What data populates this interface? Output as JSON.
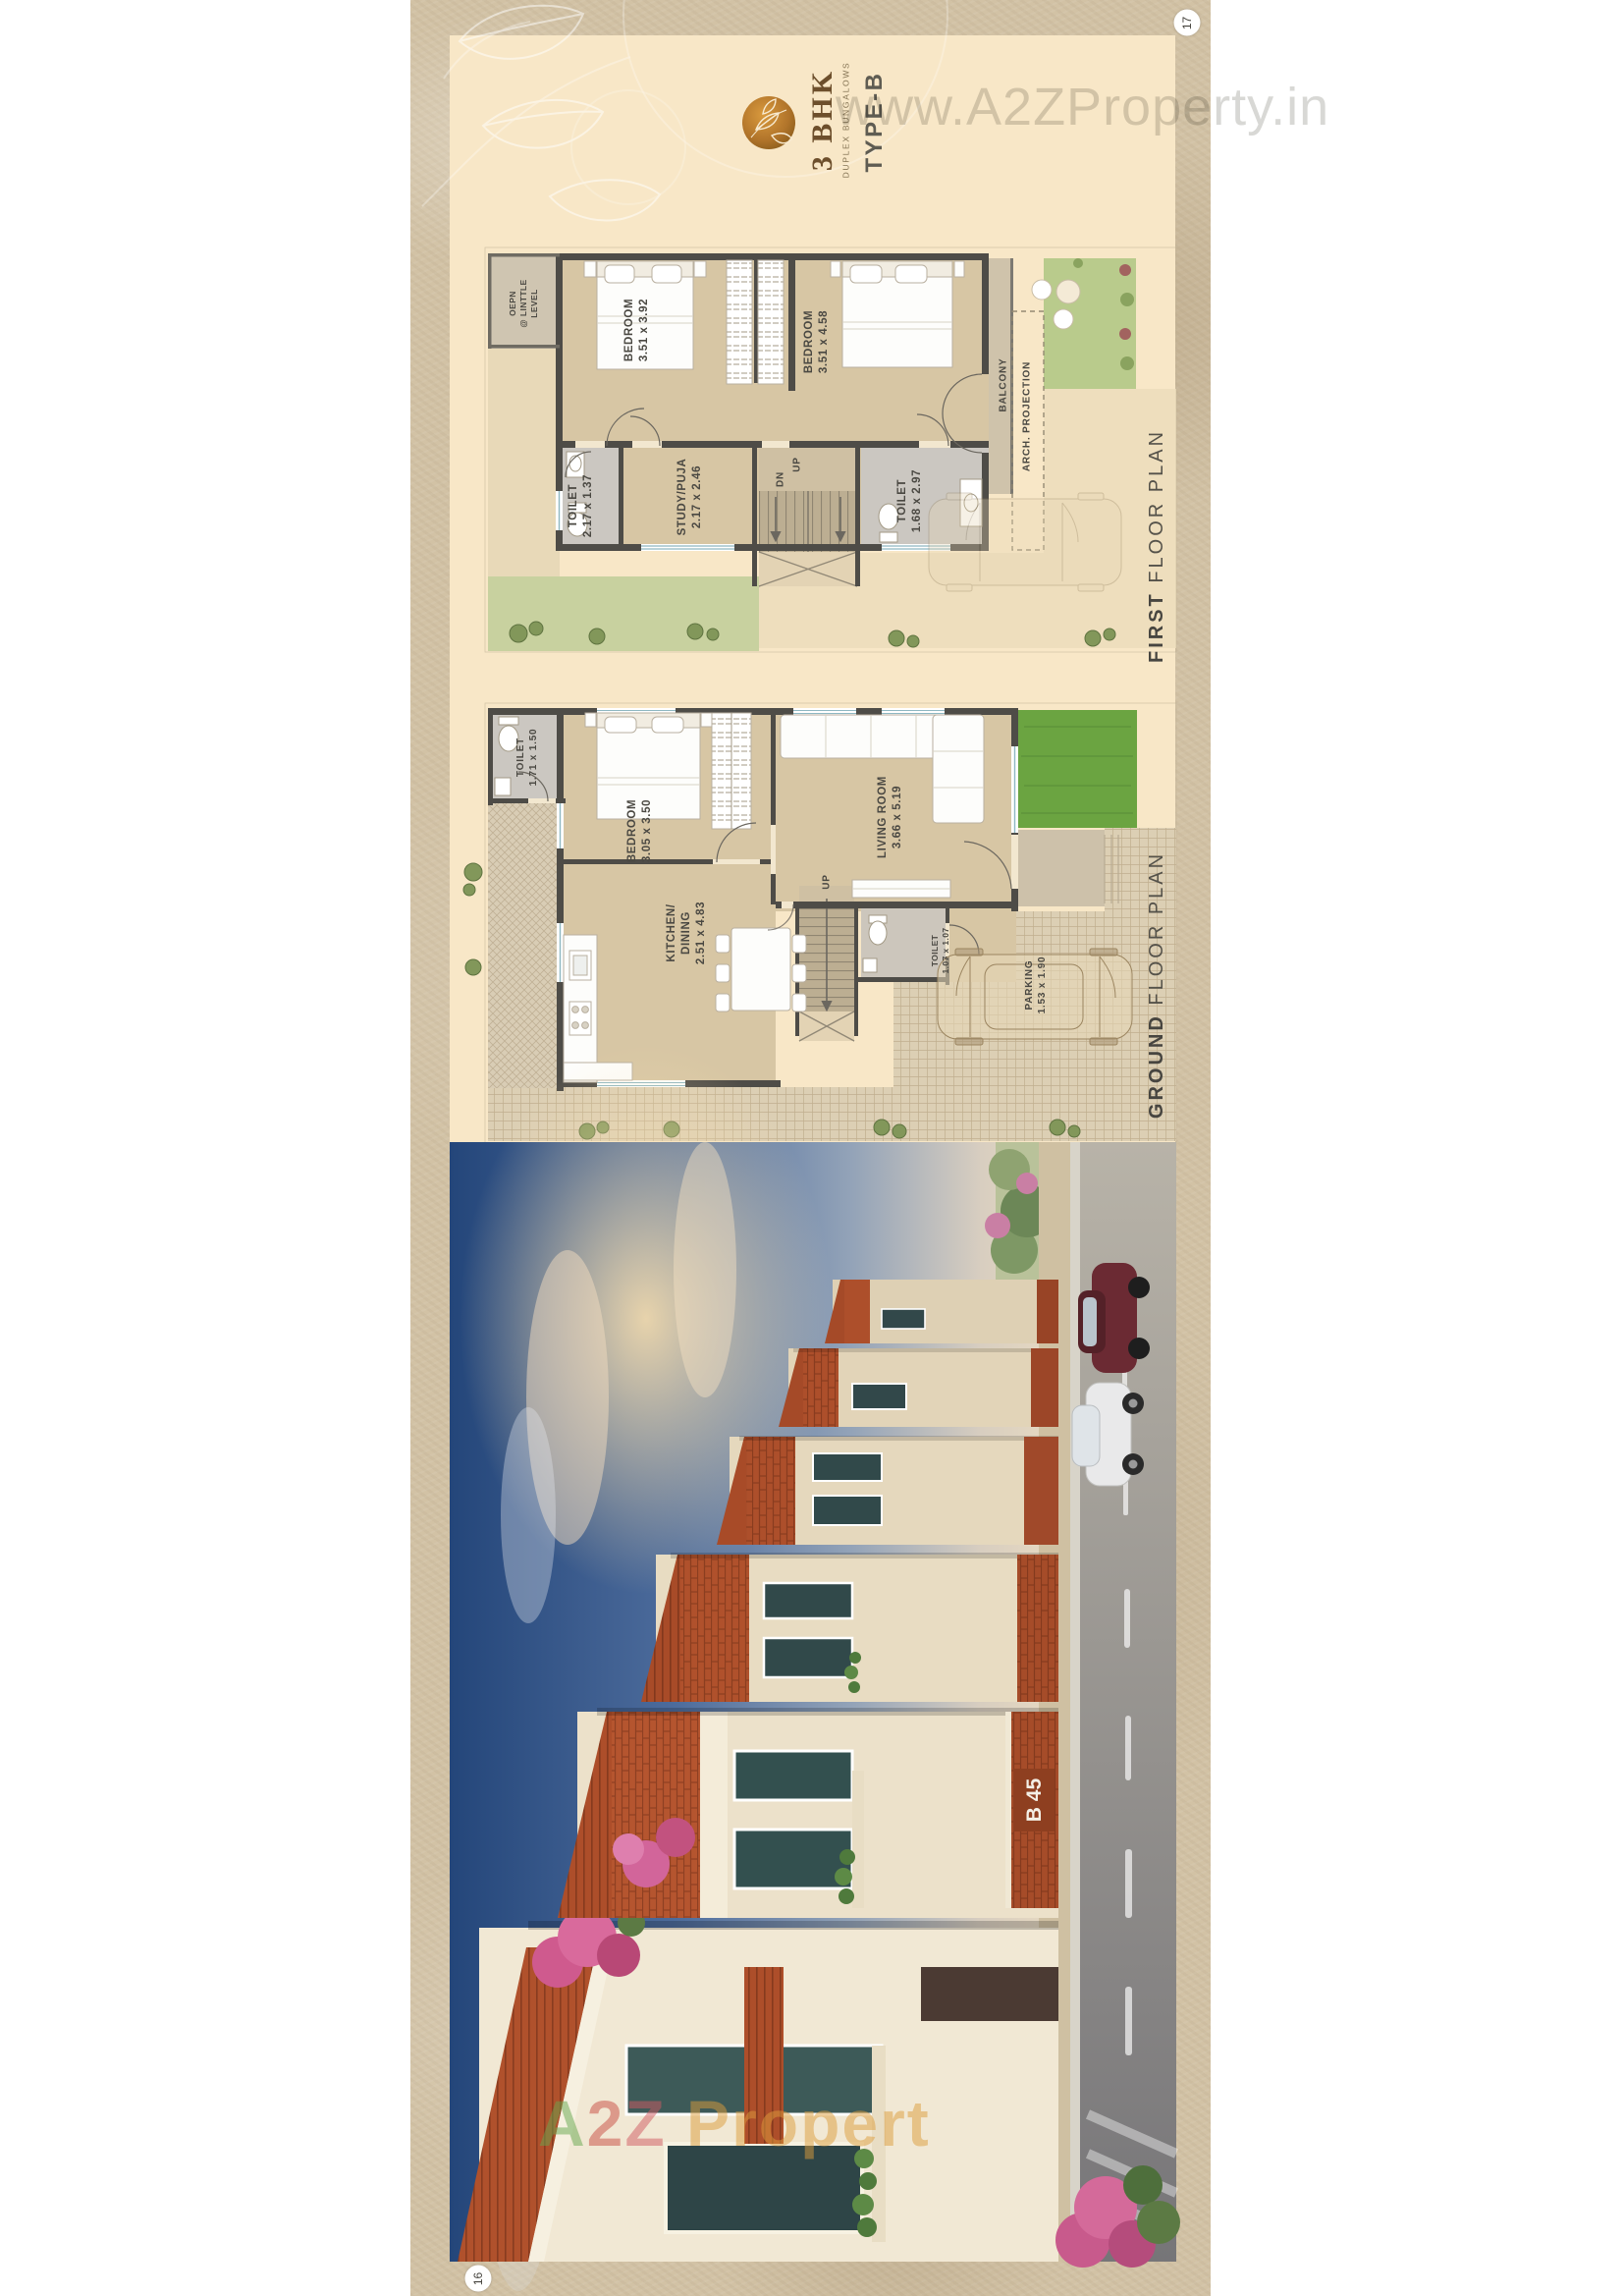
{
  "page": {
    "top_page_number": "17",
    "bottom_page_number": "16"
  },
  "watermarks": {
    "top": "www.A2ZProperty.in",
    "render_a": "A",
    "render_2": "2",
    "render_z": "Z",
    "render_rest": " Propert"
  },
  "logo": {
    "title": "3 BHK",
    "subtitle": "DUPLEX BUNGALOWS",
    "variant": "TYPE-B"
  },
  "first_floor": {
    "caption_primary": "FIRST",
    "caption_secondary": " FLOOR PLAN",
    "labels": {
      "terrace": "OEPN\n@ LINTTLE\nLEVEL",
      "bedroom_left": "BEDROOM\n3.51 x 3.92",
      "bedroom_right": "BEDROOM\n3.51 x 4.58",
      "balcony": "BALCONY",
      "arch_projection": "ARCH. PROJECTION",
      "toilet_left": "TOILET\n2.17 x 1.37",
      "study": "STUDY/PUJA\n2.17 x 2.46",
      "toilet_right": "TOILET\n1.68 x 2.97",
      "stairs_down": "DN",
      "stairs_up": "UP"
    }
  },
  "ground_floor": {
    "caption_primary": "GROUND",
    "caption_secondary": " FLOOR PLAN",
    "labels": {
      "toilet": "TOILET\n1.71 x 1.50",
      "bedroom": "BEDROOM\n3.05 x 3.50",
      "living": "LIVING ROOM\n3.66 x 5.19",
      "kitchen": "KITCHEN/\nDINING\n2.51 x 4.83",
      "toilet_small": "TOILET\n1.07 x 1.07",
      "parking": "PARKING\n1.53 x 1.90",
      "stairs_up": "UP"
    }
  },
  "render": {
    "house_sign": "B 45"
  },
  "colors": {
    "accent_gold": "#a9752f",
    "plan_wall": "#4e4c47",
    "plan_floor": "#d7c6a4",
    "lawn_bright": "#6ba441",
    "lawn_soft": "#c8d19f",
    "roof_terracotta": "#ad4e2a",
    "sky_deep": "#24467a",
    "watermark_gray": "#d6d6d3"
  }
}
